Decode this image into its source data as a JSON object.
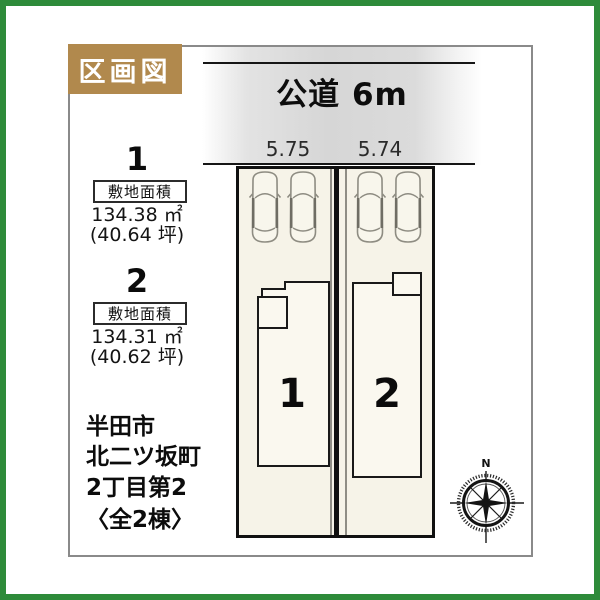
{
  "badge": {
    "label": "区画図"
  },
  "road": {
    "label": "公道 6m"
  },
  "frontage": {
    "lot1": "5.75",
    "lot2": "5.74"
  },
  "lot_info": {
    "lot1": {
      "number": "1",
      "area_label": "敷地面積",
      "area_m2": "134.38 ㎡",
      "area_tsubo": "(40.64 坪)"
    },
    "lot2": {
      "number": "2",
      "area_label": "敷地面積",
      "area_m2": "134.31 ㎡",
      "area_tsubo": "(40.62 坪)"
    }
  },
  "plan": {
    "building1_number": "1",
    "building2_number": "2"
  },
  "address": {
    "line1": "半田市",
    "line2": "北二ツ坂町",
    "line3": "2丁目第2",
    "line4": "〈全2棟〉"
  },
  "compass": {
    "north": "N"
  },
  "colors": {
    "frame_green": "#2e8b3a",
    "badge_brown": "#b1894d",
    "lot_fill": "#f6f3e8",
    "building_fill": "#faf8ef",
    "road_gray": "#d6d6d6"
  }
}
